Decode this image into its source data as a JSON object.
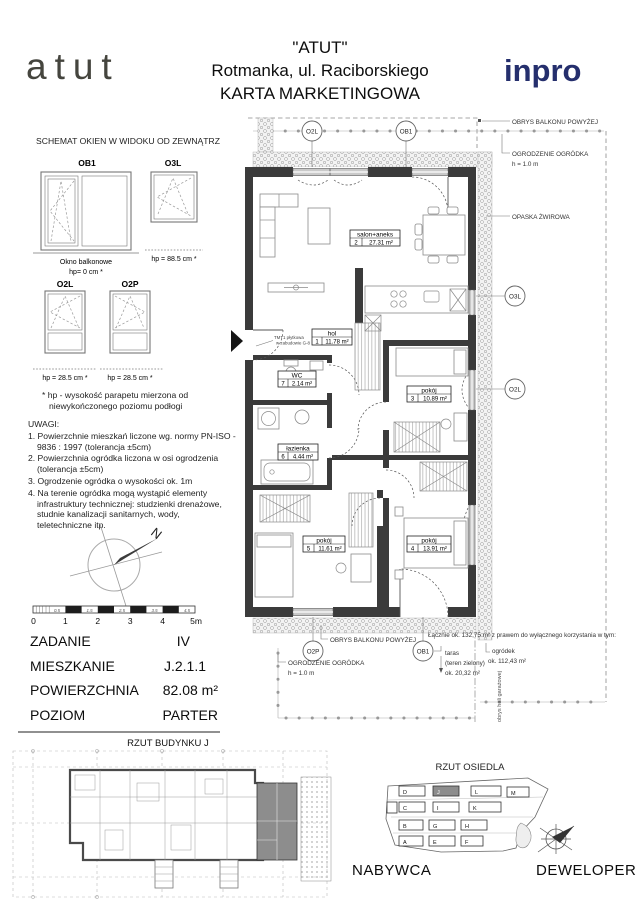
{
  "header": {
    "brand": "atut",
    "title1": "\"ATUT\"",
    "title2": "Rotmanka, ul. Raciborskiego",
    "title3": "KARTA MARKETINGOWA",
    "logo": "inpro"
  },
  "windows": {
    "section_title": "SCHEMAT OKIEN W WIDOKU OD ZEWNĄTRZ",
    "ob1": {
      "code": "OB1",
      "caption1": "Okno balkonowe",
      "caption2": "hp= 0 cm *"
    },
    "o3l": {
      "code": "O3L",
      "caption": "hp = 88.5 cm *"
    },
    "o2l": {
      "code": "O2L",
      "caption": "hp = 28.5 cm *"
    },
    "o2p": {
      "code": "O2P",
      "caption": "hp = 28.5 cm *"
    },
    "footnote1": "* hp - wysokość parapetu mierzona od",
    "footnote2": "niewykończonego poziomu podłogi"
  },
  "uwagi": {
    "title": "UWAGI:",
    "items": [
      "1. Powierzchnie mieszkań liczone wg. normy PN-ISO - 9836 : 1997 (tolerancja ±5cm)",
      "2. Powierzchnia ogródka liczona w osi ogrodzenia (tolerancja ±5cm)",
      "3. Ogrodzenie ogródka o wysokości ok. 1m",
      "4. Na terenie ogródka mogą wystąpić elementy infrastruktury technicznej: studzienki drenażowe, studnie kanalizacji sanitarnych, wody, teletechniczne itp."
    ]
  },
  "scalebar": {
    "major": [
      "0",
      "1",
      "2",
      "3",
      "4",
      "5m"
    ],
    "minor": [
      "0.5",
      "1.5",
      "2.5",
      "3.5",
      "4.5"
    ]
  },
  "info": {
    "rows": [
      {
        "label": "ZADANIE",
        "value": "IV"
      },
      {
        "label": "MIESZKANIE",
        "value": "J.2.1.1"
      },
      {
        "label": "POWIERZCHNIA",
        "value": "82.08 m²"
      },
      {
        "label": "POZIOM",
        "value": "PARTER"
      }
    ]
  },
  "plan": {
    "rooms": [
      {
        "name": "salon+aneks",
        "no": "2",
        "area": "27.31 m²"
      },
      {
        "name": "hol",
        "no": "1",
        "area": "11.78 m²"
      },
      {
        "name": "WC",
        "no": "7",
        "area": "2.14 m²"
      },
      {
        "name": "pokój",
        "no": "3",
        "area": "10.89 m²"
      },
      {
        "name": "łazienka",
        "no": "6",
        "area": "4.44 m²"
      },
      {
        "name": "pokój",
        "no": "5",
        "area": "11.61 m²"
      },
      {
        "name": "pokój",
        "no": "4",
        "area": "13.91 m²"
      }
    ],
    "markers": {
      "top1": "O2L",
      "top2": "OB1",
      "right1": "O3L",
      "right2": "O2L",
      "bottom1": "O2P",
      "bottom2": "OB1"
    },
    "ann": {
      "obrys_balkonu": "OBRYS BALKONU POWYŻEJ",
      "ogrodzenie": "OGRODZENIE OGRÓDKA",
      "ogrodzenie_h": "h = 1.0 m",
      "opaska": "OPASKA ŻWIROWA",
      "tmt1": "TMT1 płytkowa",
      "tmt2": "w zabudowie G-8",
      "lacznie": "Łącznie ok. 132,75 m² z prawem do wyłącznego korzystania w tym:",
      "taras1": "taras",
      "taras2": "(teren zielony)",
      "taras3": "ok. 20,32 m²",
      "ogrodek1": "ogródek",
      "ogrodek2": "ok. 112,43 m²",
      "obrys_hali": "obrys hali garażowej"
    }
  },
  "bottom": {
    "building_title": "RZUT BUDYNKU J",
    "estate_title": "RZUT OSIEDLA",
    "buyer": "NABYWCA",
    "developer": "DEWELOPER",
    "buildings": [
      "D",
      "J",
      "L",
      "M",
      "C",
      "I",
      "K",
      "B",
      "G",
      "H",
      "A",
      "E",
      "F"
    ],
    "compass_north": "N"
  },
  "colors": {
    "inpro_navy": "#252f6d",
    "highlight": "#8d8d8d"
  }
}
